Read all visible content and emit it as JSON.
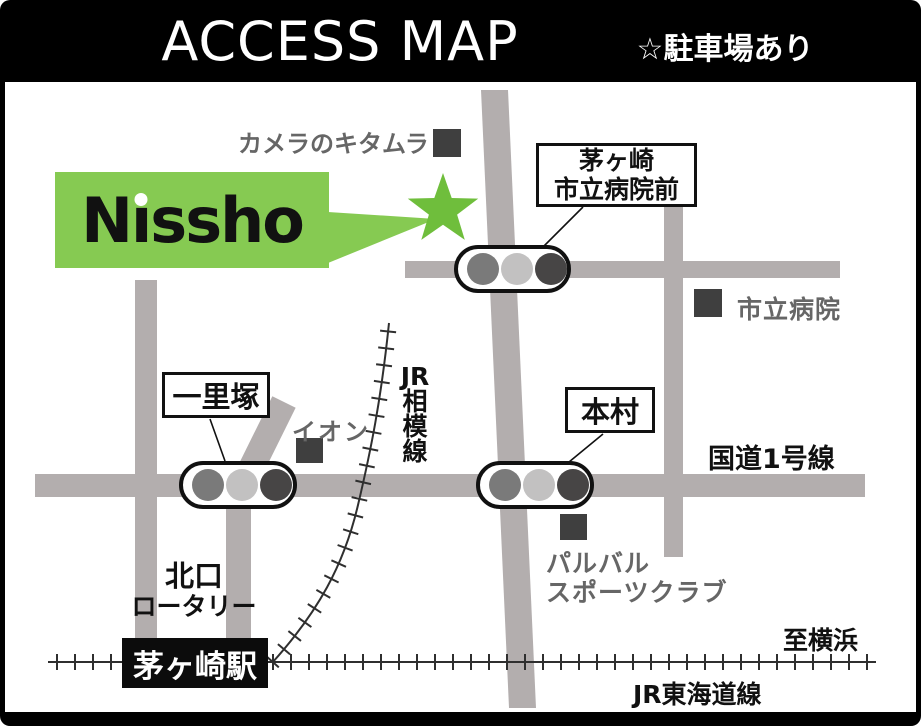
{
  "header": {
    "title": "ACCESS MAP",
    "note": "☆駐車場あり"
  },
  "logo": {
    "text": "Nissho"
  },
  "signs": {
    "hospital_mae": {
      "line1": "茅ヶ崎",
      "line2": "市立病院前"
    },
    "ichirizuka": "一里塚",
    "honmura": "本村"
  },
  "landmarks": {
    "camera_kitamura": "カメラのキタムラ",
    "aeon": "イオン",
    "city_hospital": "市立病院",
    "palval_line1": "パルバル",
    "palval_line2": "スポーツクラブ"
  },
  "roads": {
    "route1": "国道1号線"
  },
  "railways": {
    "sagami": [
      "JR",
      "相",
      "模",
      "線"
    ],
    "tokaido": "JR東海道線",
    "to_yokohama": "至横浜"
  },
  "station": {
    "name": "茅ヶ崎駅",
    "north_exit_line1": "北口",
    "north_exit_line2": "ロータリー"
  },
  "colors": {
    "logo_green": "#86ca52",
    "star_green": "#6fbe3c",
    "road_gray": "#b3aeae",
    "dark_square": "#3f3f3f",
    "light_left": "#7a7a7a",
    "light_mid": "#c2c1c1",
    "light_right": "#474545"
  }
}
